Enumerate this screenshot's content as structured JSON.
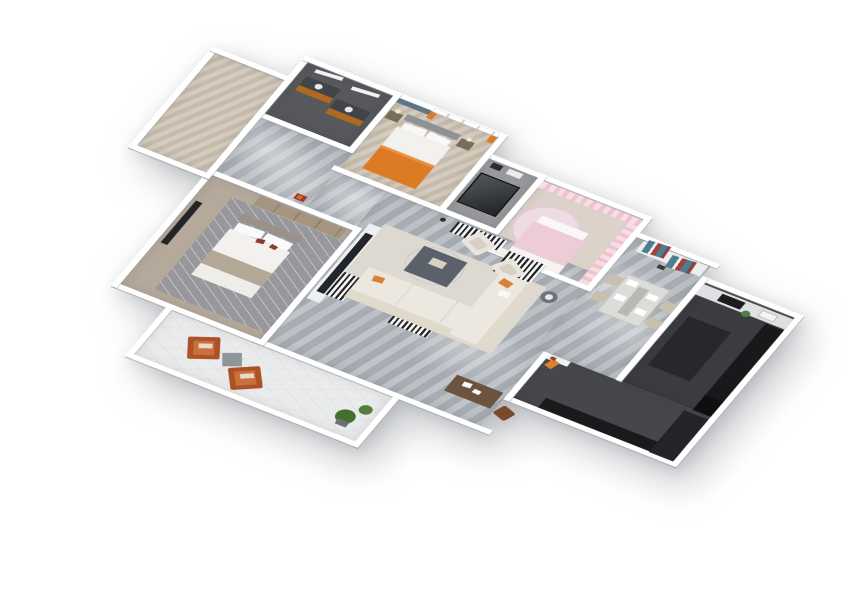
{
  "scene": {
    "description": "3D isometric rendered floor plan of a four-room apartment, viewed from above at an angle on a white background",
    "view": "axonometric top-down render",
    "background_color": "#ffffff"
  },
  "palette": {
    "wall": "#ffffff",
    "marble_floor": "#b2b7bd",
    "wood_floor": "#cfc5b6",
    "dark_bath_floor": "#57585c",
    "kitchen_floor": "#3a3c40",
    "corridor_floor": "#45474b",
    "balcony_floor": "#eaebed",
    "orange_accent": "#dd7b24",
    "rust_chair": "#ad5226",
    "pink_accent": "#edccd7",
    "teal_accent": "#4e7d92",
    "red_accent": "#a3403c",
    "cream_sofa": "#ece8e0",
    "dark_counter": "#18191b",
    "plant_green": "#4e8040"
  },
  "rooms": [
    {
      "id": "bath1",
      "name": "dark bathroom with twin orange vanities and mirrors"
    },
    {
      "id": "bed2",
      "name": "bedroom with orange blanket bed, window with orange curtains and blue-grey accent wall"
    },
    {
      "id": "bath3",
      "name": "bathroom with black-framed glass shower enclosure"
    },
    {
      "id": "bed3",
      "name": "pink bedroom with pink curtains, round rug and pink bed"
    },
    {
      "id": "dining",
      "name": "dining area with table, four beige chairs and sideboard with teal-red striped art panels"
    },
    {
      "id": "kitchen",
      "name": "dark kitchen with black counters, cooktop, sink and green plant"
    },
    {
      "id": "bath2",
      "name": "bathroom with vanity basin, brown cabinet, tub deck and round pouf"
    },
    {
      "id": "master",
      "name": "master bedroom with white and taupe bed, grey rug, wardrobe and wall TV"
    },
    {
      "id": "living",
      "name": "living room with L-shaped cream sofa, two armchairs, dark coffee table, striped rugs, TV console and writing desk"
    },
    {
      "id": "hall",
      "name": "hallway with grey marble floor and red wall artwork"
    },
    {
      "id": "corridor",
      "name": "dark utility corridor with black wall panels and orange bag"
    },
    {
      "id": "balcony",
      "name": "balcony with two rust lounge chairs, grey cube table and green plants"
    }
  ]
}
